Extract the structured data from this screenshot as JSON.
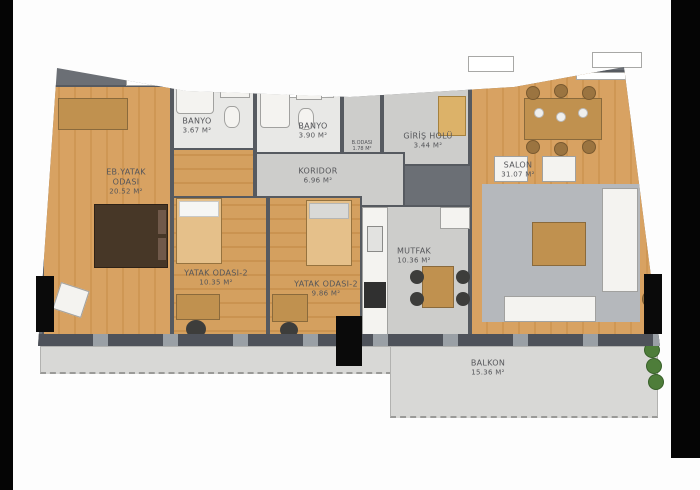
{
  "document": {
    "type": "apartment-floor-plan",
    "language": "Turkish"
  },
  "rooms": {
    "master_bedroom": {
      "name": "EB.YATAK",
      "name2": "ODASI",
      "area": "20.52 M²"
    },
    "bathroom_1": {
      "name": "BANYO",
      "area": "3.67 M²"
    },
    "bathroom_2": {
      "name": "BANYO",
      "area": "3.90 M²"
    },
    "closet": {
      "name": "B.ODASI",
      "area": "1.78 M²"
    },
    "entrance_hall": {
      "name": "GİRİŞ HOLÜ",
      "area": "3.44 M²"
    },
    "living_room": {
      "name": "SALON",
      "area": "31.07 M²"
    },
    "corridor": {
      "name": "KORIDOR",
      "area": "6.96 M²"
    },
    "bedroom_2": {
      "name": "YATAK ODASI-2",
      "area": "10.35 M²"
    },
    "bedroom_3": {
      "name": "YATAK ODASI-2",
      "area": "9.86 M²"
    },
    "kitchen": {
      "name": "MUTFAK",
      "area": "10.36 M²"
    },
    "balcony": {
      "name": "BALKON",
      "area": "15.36 M²"
    }
  },
  "palette": {
    "wall": "#565a60",
    "wood_floor": "#d8a262",
    "gray_floor": "#cdcdcb",
    "bath_floor": "#e8e8e6",
    "balcony_floor": "#d8d8d6",
    "edge_bar_black": "#050505",
    "plant_green": "#4e7d3a",
    "bed_dark_brown": "#473727",
    "furniture_wood": "#c0914f"
  }
}
